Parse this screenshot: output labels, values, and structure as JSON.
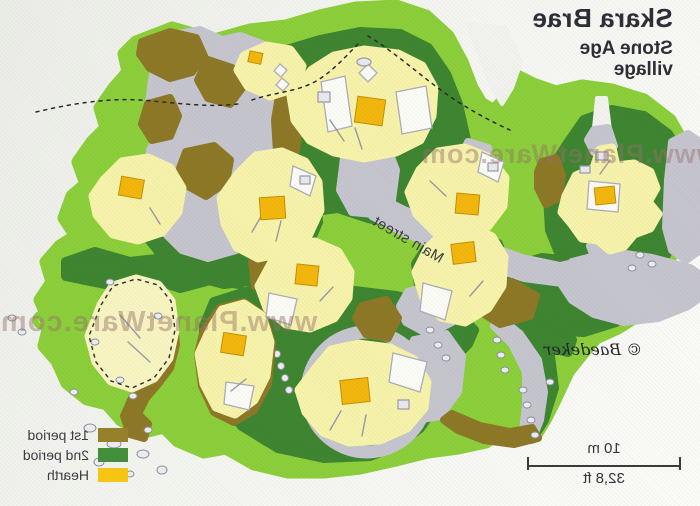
{
  "header": {
    "title": "Skara Brae",
    "subtitle_line1": "Stone Age",
    "subtitle_line2": "village"
  },
  "watermark": {
    "text": "www.PlanetWare.com"
  },
  "map": {
    "street_label": "Main street",
    "copyright": "© Baedeker"
  },
  "legend": {
    "items": [
      {
        "label": "1st period",
        "color": "#97812b"
      },
      {
        "label": "2nd period",
        "color": "#44903c"
      },
      {
        "label": "Hearth",
        "color": "#f8c713"
      }
    ]
  },
  "scale_bar": {
    "metric": "10 m",
    "imperial": "32,8 ft"
  },
  "colors": {
    "paper": "#f2f3ee",
    "coast_light_green": "#8ccf3b",
    "second_period_green": "#3e8531",
    "first_period_olive": "#8d7827",
    "passage_gray": "#c6c5cf",
    "house_pale_yellow": "#f7f3ab",
    "hearth_gold": "#f3b70d",
    "title_text": "#2e2e36",
    "label_text": "#3c3c40",
    "watermark_tint": "rgba(151,112,106,0.45)"
  }
}
